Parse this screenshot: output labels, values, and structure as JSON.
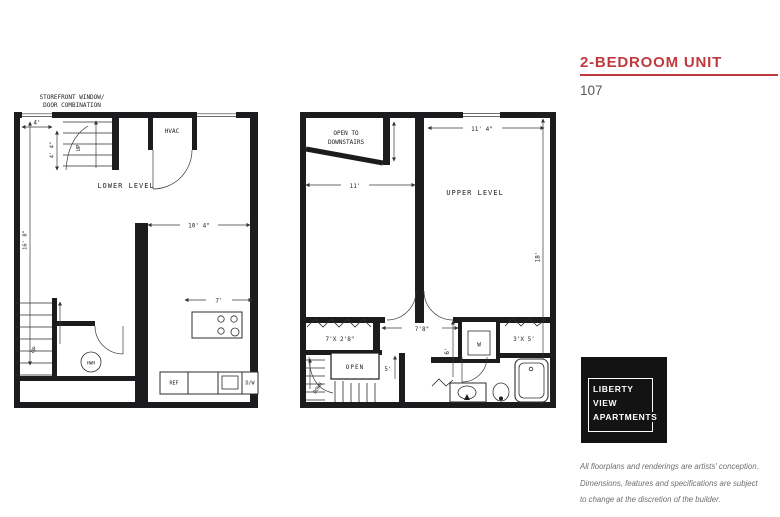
{
  "header": {
    "title": "2-BEDROOM UNIT",
    "unit_number": "107",
    "accent_color": "#c0393e"
  },
  "logo": {
    "line1": "LIBERTY",
    "line2": "VIEW",
    "line3": "APARTMENTS"
  },
  "disclaimer": {
    "line1": "All floorplans and renderings are artists' conception.",
    "line2": "Dimensions, features and specifications are subject",
    "line3": "to change at the discretion of the builder."
  },
  "lower_plan": {
    "annotation_line1": "STOREFRONT WINDOW/",
    "annotation_line2": "DOOR COMBINATION",
    "room_label": "LOWER LEVEL",
    "door_width": "4'",
    "stair_depth": "4' 4\"",
    "side_length": "16' 8\"",
    "living_width": "10' 4\"",
    "kitchen_width": "7'",
    "hvac": "HVAC",
    "up": "UP",
    "water_heater": "HWH",
    "refrigerator": "REF",
    "dishwasher": "D/W"
  },
  "upper_plan": {
    "open_line1": "OPEN TO",
    "open_line2": "DOWNSTAIRS",
    "room_label": "UPPER LEVEL",
    "left_room_width": "11'",
    "right_room_width": "11' 4\"",
    "side_length": "18'",
    "closet_left": "7'X 2'8\"",
    "hall_width": "7'8\"",
    "closet_right": "3'X 5'",
    "washer": "W",
    "stair_open": "OPEN",
    "down": "DOWN",
    "stair_width": "5'",
    "hall_depth": "6'"
  }
}
